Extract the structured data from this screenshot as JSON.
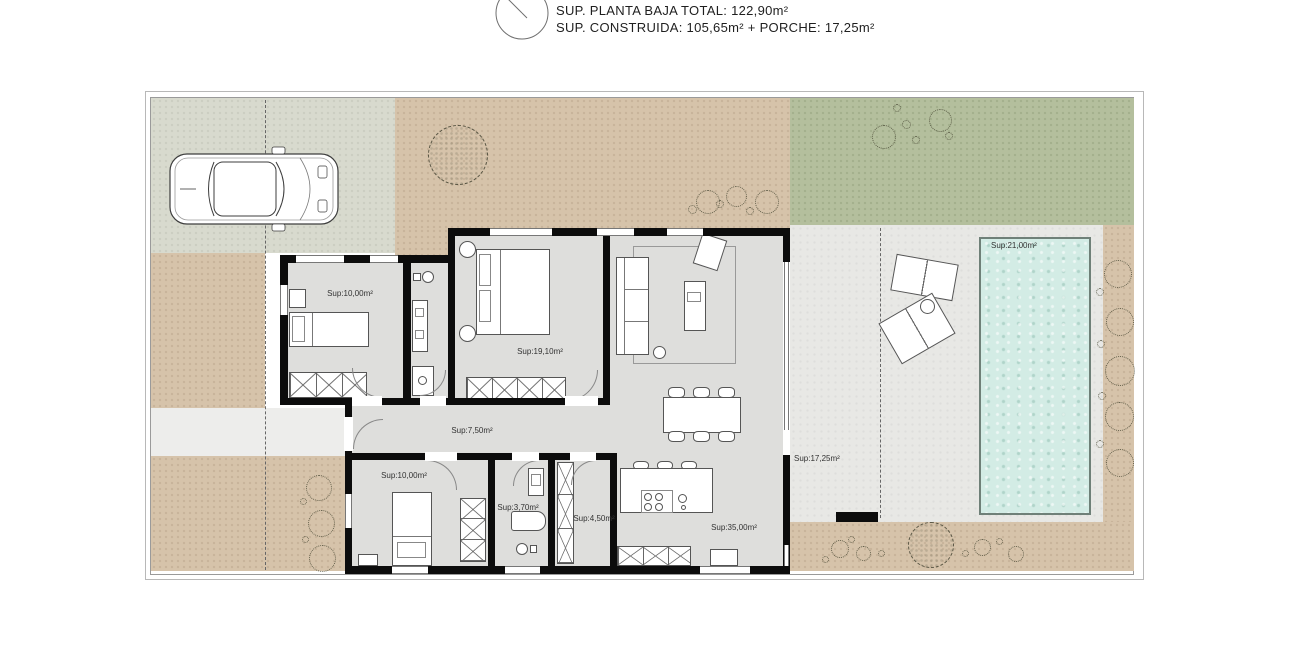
{
  "header": {
    "line1": "SUP. PLANTA BAJA TOTAL: 122,90m²",
    "line2": "SUP. CONSTRUIDA: 105,65m² + PORCHE: 17,25m²",
    "compass_icon": "north-compass-icon"
  },
  "plan": {
    "rooms": [
      {
        "id": "bedroom-1",
        "label": "Sup:10,00m²"
      },
      {
        "id": "master-bedroom",
        "label": "Sup:19,10m²"
      },
      {
        "id": "hallway",
        "label": "Sup:7,50m²"
      },
      {
        "id": "bedroom-2",
        "label": "Sup:10,00m²"
      },
      {
        "id": "bathroom-2",
        "label": "Sup:3,70m²"
      },
      {
        "id": "laundry",
        "label": "Sup:4,50m²"
      },
      {
        "id": "kitchen-living",
        "label": "Sup:35,00m²"
      },
      {
        "id": "porch",
        "label": "Sup:17,25m²"
      },
      {
        "id": "pool",
        "label": "Sup:21,00m²"
      }
    ],
    "colors": {
      "driveway": "#d8dace",
      "gravel": "#d6c3aa",
      "lawn": "#b4bf9d",
      "terrace": "#e8e8e5",
      "pool_water": "#d3ece5",
      "floor": "#dededc",
      "wall": "#0c0c0c"
    },
    "icons": [
      "north-compass-icon",
      "car-top-view-icon",
      "tree-icon",
      "shrub-icon"
    ]
  }
}
